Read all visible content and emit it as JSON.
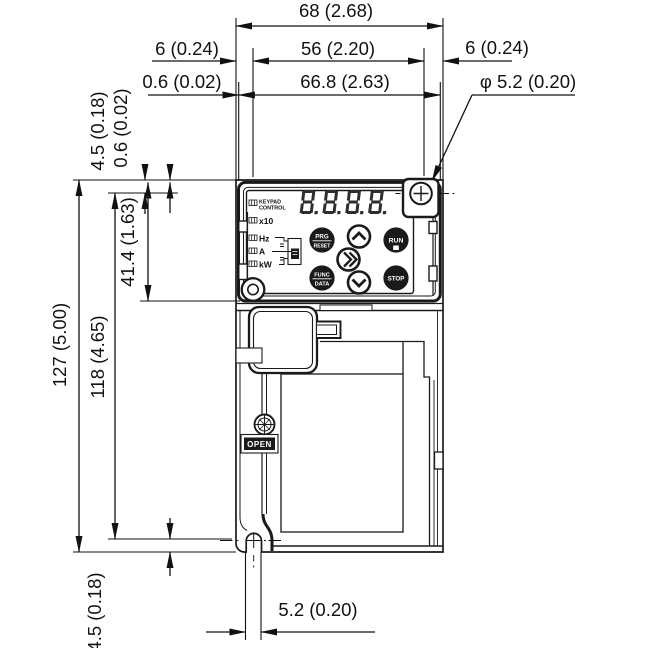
{
  "drawing": {
    "dims": {
      "width_overall": "68 (2.68)",
      "hole_span_h": "56 (2.20)",
      "panel_width": "66.8 (2.63)",
      "edge_left": "6 (0.24)",
      "edge_right": "6 (0.24)",
      "panel_inset_h": "0.6 (0.02)",
      "hole_dia": "φ 5.2 (0.20)",
      "hole_top_offset": "4.5 (0.18)",
      "panel_inset_v": "0.6 (0.02)",
      "keypad_height": "41.4 (1.63)",
      "height_overall": "127 (5.00)",
      "hole_span_v": "118 (4.65)",
      "hole_bottom_offset": "4.5 (0.18)",
      "slot_width": "5.2 (0.20)"
    },
    "keypad": {
      "display": "8.8.8.8.",
      "leds": {
        "l1": "KEYPAD",
        "l2": "CONTROL",
        "x10": "x10",
        "hz": "Hz",
        "a": "A",
        "kw": "kW"
      },
      "buttons": {
        "prg": "PRG",
        "reset": "RESET",
        "func": "FUNC",
        "data": "DATA",
        "run": "RUN",
        "stop": "STOP"
      },
      "open": "OPEN"
    }
  }
}
